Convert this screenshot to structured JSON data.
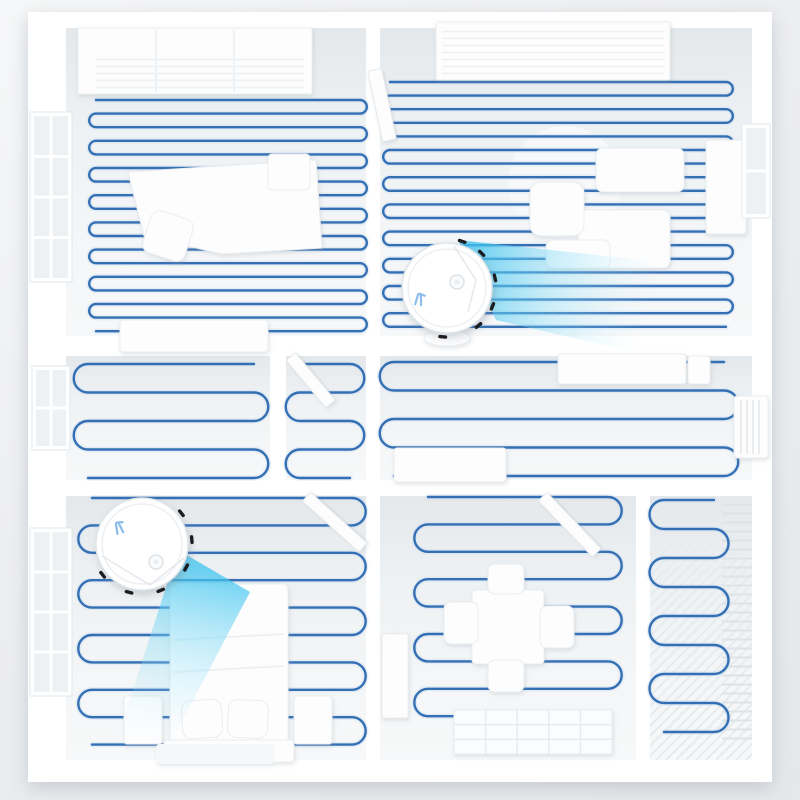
{
  "scene": {
    "name": "robot-vacuum-floorplan-render",
    "colors": {
      "plate": "#ffffff",
      "floor_stops": [
        "#e4e8ea",
        "#eef1f3",
        "#f4f6f7",
        "#f7f8f9"
      ],
      "path": "#346fb4",
      "path_halo": "#cfe0f2",
      "cone_near": "#3fc4ef",
      "cone_mid": "#7cd9f5",
      "cone_far": "#c9f0fc",
      "furniture_fill": "#fdfdfe",
      "furniture_stroke": "#e9edf0",
      "glass": "#edf1f4",
      "mullion": "#ffffff",
      "tick": "#1b1d20",
      "robot_body": "#ffffff",
      "robot_rim": "#e0e5e9",
      "robot_inner": "#edf0f3",
      "logo": "#8abde9"
    },
    "canvas": {
      "w": 800,
      "h": 800
    },
    "plate": {
      "x": 28,
      "y": 12,
      "w": 744,
      "h": 770
    }
  },
  "floors": [
    {
      "name": "study",
      "x": 66,
      "y": 28,
      "w": 300,
      "h": 308
    },
    {
      "name": "living-room",
      "x": 380,
      "y": 28,
      "w": 372,
      "h": 308
    },
    {
      "name": "mid-left-room",
      "x": 66,
      "y": 356,
      "w": 204,
      "h": 124
    },
    {
      "name": "closet",
      "x": 286,
      "y": 356,
      "w": 80,
      "h": 124
    },
    {
      "name": "hallway",
      "x": 380,
      "y": 356,
      "w": 372,
      "h": 124
    },
    {
      "name": "bedroom",
      "x": 66,
      "y": 496,
      "w": 300,
      "h": 264
    },
    {
      "name": "dining-room",
      "x": 380,
      "y": 496,
      "w": 256,
      "h": 264
    },
    {
      "name": "balcony",
      "x": 650,
      "y": 496,
      "w": 102,
      "h": 264
    }
  ],
  "cleaning_paths": [
    {
      "room": "study",
      "x1": 96,
      "x2": 360,
      "yTop": 100,
      "spacing": 13.6,
      "lines": 18,
      "start": "right"
    },
    {
      "room": "living-room",
      "x1": 390,
      "x2": 726,
      "yTop": 82,
      "spacing": 13.6,
      "lines": 19,
      "start": "right"
    },
    {
      "room": "mid-left-room",
      "x1": 88,
      "x2": 254,
      "yTop": 364,
      "spacing": 28.5,
      "lines": 5,
      "start": "left"
    },
    {
      "room": "closet",
      "x1": 300,
      "x2": 350,
      "yTop": 364,
      "spacing": 28.5,
      "lines": 5,
      "start": "right"
    },
    {
      "room": "hallway",
      "x1": 394,
      "x2": 724,
      "yTop": 362,
      "spacing": 28.5,
      "lines": 5,
      "start": "left"
    },
    {
      "room": "bedroom",
      "x1": 92,
      "x2": 352,
      "yTop": 498,
      "spacing": 27.4,
      "lines": 10,
      "start": "right"
    },
    {
      "room": "dining-room",
      "x1": 428,
      "x2": 608,
      "yTop": 497,
      "spacing": 27.4,
      "lines": 9,
      "start": "right"
    },
    {
      "room": "balcony",
      "x1": 664,
      "x2": 714,
      "yTop": 500,
      "spacing": 29,
      "lines": 9,
      "start": "left"
    }
  ],
  "furniture": [
    {
      "name": "round-rug",
      "kind": "circle",
      "cx": 565,
      "cy": 183,
      "r": 57,
      "fill": "#f6f8fa",
      "stroke": "none",
      "layer": "under"
    },
    {
      "name": "balcony-slats",
      "kind": "stripes",
      "x": 650,
      "y": 496,
      "w": 102,
      "h": 264,
      "gap": 10,
      "dir": "d",
      "color": "#e7ebee",
      "lw": 2,
      "layer": "under"
    },
    {
      "name": "balcony-rack",
      "kind": "stripes",
      "x": 722,
      "y": 500,
      "w": 30,
      "h": 240,
      "gap": 9,
      "dir": "h",
      "color": "#dde3e7",
      "lw": 2,
      "layer": "under"
    },
    {
      "name": "wardrobe",
      "kind": "rect",
      "x": 78,
      "y": 28,
      "w": 234,
      "h": 66
    },
    {
      "name": "wardrobe-seam-1",
      "kind": "line",
      "x1": 156,
      "y1": 30,
      "x2": 156,
      "y2": 92,
      "color": "#e9edf0",
      "w": 1.5
    },
    {
      "name": "wardrobe-seam-2",
      "kind": "line",
      "x1": 234,
      "y1": 30,
      "x2": 234,
      "y2": 92,
      "color": "#e9edf0",
      "w": 1.5
    },
    {
      "name": "wardrobe-louvers",
      "kind": "stripes",
      "x": 96,
      "y": 56,
      "w": 208,
      "h": 36,
      "gap": 7,
      "dir": "h",
      "color": "#eff2f4",
      "lw": 2
    },
    {
      "name": "study-desk",
      "kind": "polygon",
      "pts": [
        [
          128,
          172
        ],
        [
          316,
          160
        ],
        [
          322,
          248
        ],
        [
          222,
          254
        ],
        [
          144,
          236
        ]
      ]
    },
    {
      "name": "desk-chair",
      "kind": "rect",
      "x": 146,
      "y": 214,
      "w": 44,
      "h": 44,
      "rx": 9,
      "rot": 18
    },
    {
      "name": "side-table",
      "kind": "rect",
      "x": 268,
      "y": 154,
      "w": 42,
      "h": 36,
      "rx": 4
    },
    {
      "name": "dresser",
      "kind": "rect",
      "x": 120,
      "y": 320,
      "w": 148,
      "h": 32,
      "rx": 3
    },
    {
      "name": "ceiling-light",
      "kind": "rect",
      "x": 436,
      "y": 22,
      "w": 234,
      "h": 58,
      "rx": 2
    },
    {
      "name": "ceiling-light-grid",
      "kind": "stripes",
      "x": 442,
      "y": 28,
      "w": 222,
      "h": 46,
      "gap": 7,
      "dir": "h",
      "color": "#eef1f3",
      "lw": 1.5
    },
    {
      "name": "sofa-back",
      "kind": "rect",
      "x": 596,
      "y": 148,
      "w": 88,
      "h": 44,
      "rx": 7
    },
    {
      "name": "sofa-seat",
      "kind": "rect",
      "x": 578,
      "y": 210,
      "w": 92,
      "h": 58,
      "rx": 7
    },
    {
      "name": "armchair",
      "kind": "rect",
      "x": 530,
      "y": 182,
      "w": 54,
      "h": 54,
      "rx": 11
    },
    {
      "name": "ottoman",
      "kind": "rect",
      "x": 546,
      "y": 240,
      "w": 64,
      "h": 28,
      "rx": 7
    },
    {
      "name": "tv-cabinet",
      "kind": "rect",
      "x": 706,
      "y": 140,
      "w": 40,
      "h": 94,
      "rx": 3
    },
    {
      "name": "hall-basin",
      "kind": "ellipse",
      "cx": 447,
      "cy": 338,
      "rx": 23,
      "ry": 8
    },
    {
      "name": "sideboard",
      "kind": "rect",
      "x": 558,
      "y": 354,
      "w": 128,
      "h": 30,
      "rx": 3
    },
    {
      "name": "hall-decor",
      "kind": "rect",
      "x": 688,
      "y": 356,
      "w": 22,
      "h": 28,
      "rx": 3
    },
    {
      "name": "radiator",
      "kind": "rect",
      "x": 734,
      "y": 396,
      "w": 34,
      "h": 62,
      "rx": 3
    },
    {
      "name": "radiator-fins",
      "kind": "stripes",
      "x": 738,
      "y": 400,
      "w": 26,
      "h": 54,
      "gap": 6,
      "dir": "v",
      "color": "#e9edf0",
      "lw": 2
    },
    {
      "name": "hall-cabinet",
      "kind": "rect",
      "x": 394,
      "y": 448,
      "w": 112,
      "h": 34,
      "rx": 3
    },
    {
      "name": "bed",
      "kind": "rect",
      "x": 170,
      "y": 584,
      "w": 118,
      "h": 160,
      "rx": 5
    },
    {
      "name": "duvet-fold-1",
      "kind": "line",
      "x1": 174,
      "y1": 640,
      "x2": 284,
      "y2": 634,
      "color": "#eef1f4",
      "w": 2
    },
    {
      "name": "duvet-fold-2",
      "kind": "line",
      "x1": 174,
      "y1": 672,
      "x2": 284,
      "y2": 666,
      "color": "#eef1f4",
      "w": 2
    },
    {
      "name": "pillow-left",
      "kind": "rect",
      "x": 182,
      "y": 700,
      "w": 40,
      "h": 38,
      "rx": 9,
      "rot": -4
    },
    {
      "name": "pillow-right",
      "kind": "rect",
      "x": 228,
      "y": 700,
      "w": 40,
      "h": 38,
      "rx": 9,
      "rot": 3
    },
    {
      "name": "headboard",
      "kind": "rect",
      "x": 164,
      "y": 740,
      "w": 130,
      "h": 22,
      "rx": 3
    },
    {
      "name": "nightstand-left",
      "kind": "rect",
      "x": 124,
      "y": 696,
      "w": 38,
      "h": 48,
      "rx": 3
    },
    {
      "name": "nightstand-right",
      "kind": "rect",
      "x": 294,
      "y": 696,
      "w": 38,
      "h": 48,
      "rx": 3
    },
    {
      "name": "bedside-rug",
      "kind": "rect",
      "x": 156,
      "y": 744,
      "w": 118,
      "h": 20,
      "rx": 4,
      "fill": "#f5f7f9",
      "stroke": "none"
    },
    {
      "name": "dining-table",
      "kind": "rect",
      "x": 472,
      "y": 590,
      "w": 72,
      "h": 74,
      "rx": 4
    },
    {
      "name": "chair-top",
      "kind": "rect",
      "x": 488,
      "y": 564,
      "w": 36,
      "h": 30,
      "rx": 7
    },
    {
      "name": "chair-bottom",
      "kind": "rect",
      "x": 488,
      "y": 660,
      "w": 36,
      "h": 32,
      "rx": 7
    },
    {
      "name": "chair-left",
      "kind": "rect",
      "x": 444,
      "y": 602,
      "w": 34,
      "h": 42,
      "rx": 7
    },
    {
      "name": "chair-right",
      "kind": "rect",
      "x": 540,
      "y": 606,
      "w": 34,
      "h": 42,
      "rx": 7
    },
    {
      "name": "shelf-grid",
      "kind": "grid",
      "x": 454,
      "y": 710,
      "w": 158,
      "h": 44,
      "cols": 5,
      "rows": 3
    },
    {
      "name": "wall-shelf",
      "kind": "rect",
      "x": 382,
      "y": 634,
      "w": 26,
      "h": 84,
      "rx": 2
    }
  ],
  "windows": [
    {
      "name": "window-study",
      "x": 30,
      "y": 112,
      "w": 42,
      "h": 170,
      "cols": 2,
      "rows": 4
    },
    {
      "name": "window-mid",
      "x": 32,
      "y": 366,
      "w": 38,
      "h": 84,
      "cols": 2,
      "rows": 2
    },
    {
      "name": "window-bedroom",
      "x": 30,
      "y": 528,
      "w": 42,
      "h": 168,
      "cols": 2,
      "rows": 4
    },
    {
      "name": "window-living",
      "x": 742,
      "y": 124,
      "w": 28,
      "h": 94,
      "cols": 1,
      "rows": 2
    }
  ],
  "doors": [
    {
      "name": "door-living",
      "x": 368,
      "y": 70,
      "w": 14,
      "h": 72,
      "angle": -12,
      "px": 374,
      "py": 72
    },
    {
      "name": "door-closet",
      "x": 286,
      "y": 356,
      "w": 12,
      "h": 62,
      "angle": -40,
      "px": 292,
      "py": 358
    },
    {
      "name": "door-bedroom",
      "x": 302,
      "y": 496,
      "w": 12,
      "h": 76,
      "angle": -48,
      "px": 308,
      "py": 498
    },
    {
      "name": "door-dining",
      "x": 538,
      "y": 496,
      "w": 12,
      "h": 78,
      "angle": -44,
      "px": 544,
      "py": 498
    }
  ],
  "robots": [
    {
      "name": "robot-vacuum-bedroom",
      "cx": 142,
      "cy": 544,
      "r": 46,
      "cone": {
        "pts": [
          [
            178,
            550
          ],
          [
            250,
            592
          ],
          [
            168,
            748
          ],
          [
            118,
            736
          ]
        ],
        "x1": 185,
        "y1": 565,
        "x2": 148,
        "y2": 742
      },
      "ticks": [
        -38,
        -5,
        28,
        68,
        105,
        142
      ],
      "seam": [
        [
          102,
          556
        ],
        [
          150,
          585
        ],
        [
          184,
          558
        ]
      ],
      "button": {
        "x": 156,
        "y": 562
      },
      "logo": {
        "x": 120,
        "y": 528,
        "rot": -15
      }
    },
    {
      "name": "robot-vacuum-living",
      "cx": 447,
      "cy": 288,
      "r": 45,
      "cone": {
        "pts": [
          [
            458,
            240
          ],
          [
            662,
            262
          ],
          [
            634,
            352
          ],
          [
            496,
            320
          ]
        ],
        "x1": 470,
        "y1": 258,
        "x2": 650,
        "y2": 308
      },
      "ticks": [
        -72,
        -45,
        -12,
        22,
        50,
        95
      ],
      "seam": [
        [
          454,
          246
        ],
        [
          476,
          280
        ],
        [
          468,
          312
        ]
      ],
      "button": {
        "x": 457,
        "y": 282
      },
      "logo": {
        "x": 420,
        "y": 300,
        "rot": 10
      }
    }
  ]
}
